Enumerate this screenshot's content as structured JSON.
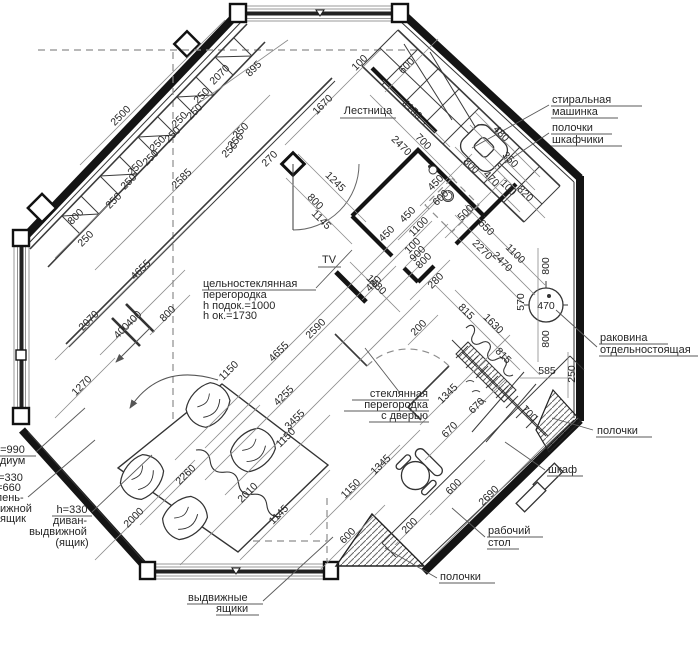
{
  "plan": {
    "rooms": {
      "stairs": "Лестница",
      "tv": "TV"
    },
    "callouts": {
      "washer": [
        "стиральная",
        "машинка"
      ],
      "shelves_cabinets": [
        "полочки",
        "шкафчики"
      ],
      "sink": [
        "раковина",
        "отдельностоящая"
      ],
      "shelves_right": "полочки",
      "wardrobe": "шкаф",
      "desk": [
        "рабочий",
        "стол"
      ],
      "shelves_bottom": "полочки",
      "drawers": [
        "выдвижные",
        "ящики"
      ],
      "glass_wall": [
        "цельностеклянная",
        "перегородка",
        "h подок.=1000",
        "h ок.=1730"
      ],
      "glass_door": [
        "стеклянная",
        "перегородка",
        "с дверью"
      ],
      "podium": [
        "h=990",
        "подиум"
      ],
      "step_drawer": [
        "h=330",
        "h=660",
        "ступень-",
        "выдвижной",
        "ящик"
      ],
      "sofa_drawer": [
        "h=330",
        "диван-",
        "выдвижной",
        "(ящик)"
      ]
    },
    "dims": {
      "top_left": [
        "2500",
        "800",
        "250",
        "2585",
        "2070",
        "895",
        "270",
        "250",
        "250",
        "250",
        "250",
        "250",
        "250",
        "250",
        "250",
        "250",
        "250",
        "250",
        "250"
      ],
      "top_mid": [
        "1670",
        "100",
        "600",
        "1150",
        "2470",
        "700",
        "1245",
        "800",
        "1145"
      ],
      "kitchen": [
        "480",
        "800",
        "350",
        "470",
        "100",
        "820",
        "450",
        "600",
        "500",
        "1100",
        "450",
        "650",
        "2270",
        "1100",
        "2470",
        "100",
        "900",
        "800",
        "280",
        "480",
        "200",
        "450"
      ],
      "right": [
        "570",
        "470",
        "800",
        "800",
        "585",
        "250",
        "815",
        "1630",
        "815",
        "700"
      ],
      "center": [
        "1480",
        "2590",
        "4655",
        "4255",
        "3455",
        "1150",
        "1150",
        "2260",
        "2010",
        "2000",
        "1145",
        "1150",
        "600",
        "1345",
        "1345",
        "670",
        "670",
        "600",
        "2690",
        "200"
      ],
      "left": [
        "2070",
        "1270",
        "400",
        "400",
        "800",
        "4655"
      ]
    }
  }
}
